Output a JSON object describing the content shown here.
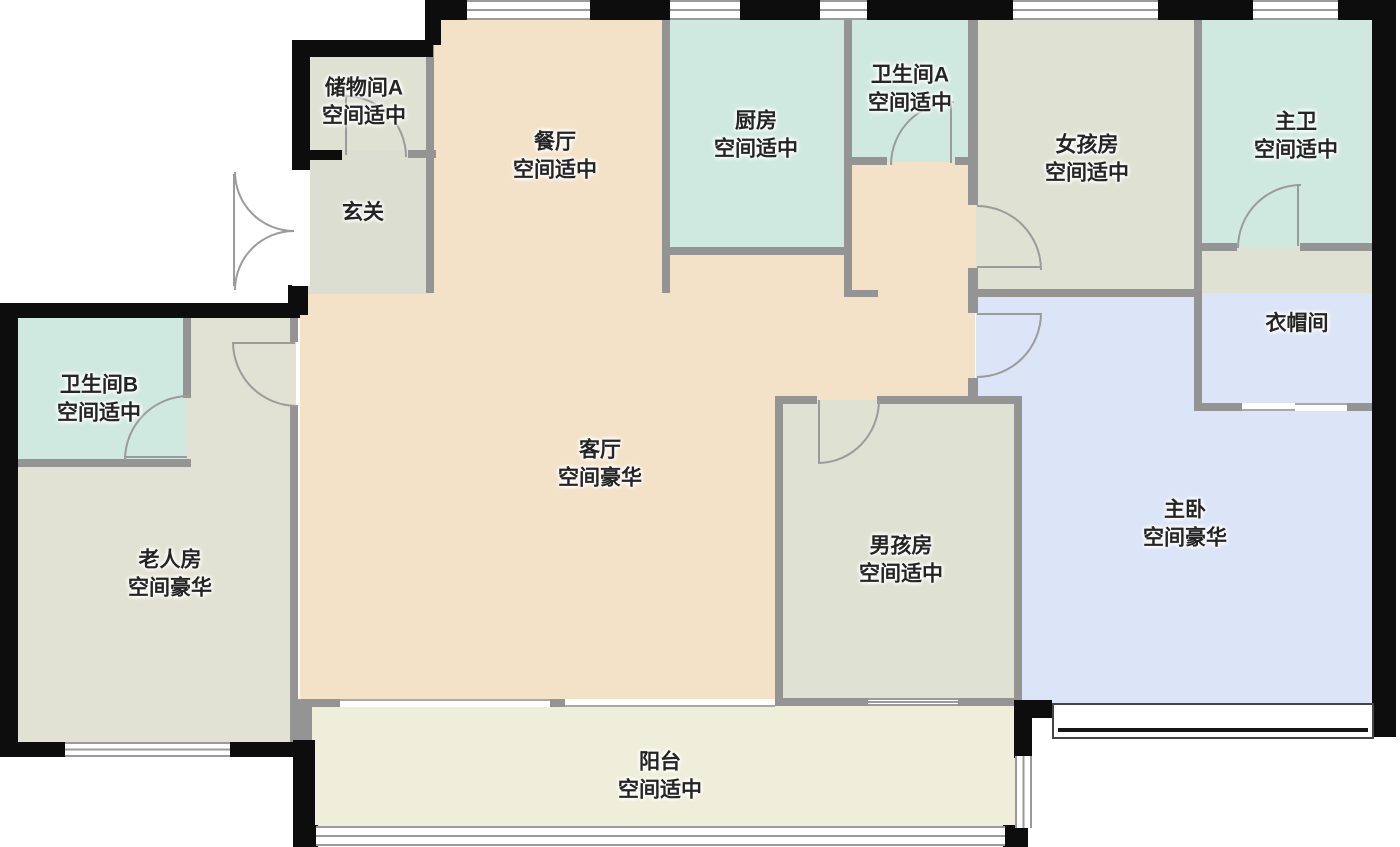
{
  "palette": {
    "wall_black": "#0d0d0d",
    "wall_gray": "#949494",
    "door_arc": "#9b9b9b",
    "dining_living": "#f3e1c8",
    "wet_room": "#cfe9e1",
    "gray_green_room": "#dfe1d3",
    "entry_green": "#dbded0",
    "elderly_room": "#e2e2d4",
    "master_blue": "#dce4f7",
    "balcony_cream": "#efeeda"
  },
  "rooms": {
    "storage_a": {
      "name": "储物间A",
      "status": "空间适中"
    },
    "entry": {
      "name": "玄关"
    },
    "dining": {
      "name": "餐厅",
      "status": "空间适中"
    },
    "kitchen": {
      "name": "厨房",
      "status": "空间适中"
    },
    "bath_a": {
      "name": "卫生间A",
      "status": "空间适中"
    },
    "girls_room": {
      "name": "女孩房",
      "status": "空间适中"
    },
    "master_bath": {
      "name": "主卫",
      "status": "空间适中"
    },
    "cloakroom": {
      "name": "衣帽间"
    },
    "bath_b": {
      "name": "卫生间B",
      "status": "空间适中"
    },
    "elderly_room": {
      "name": "老人房",
      "status": "空间豪华"
    },
    "living_room": {
      "name": "客厅",
      "status": "空间豪华"
    },
    "boys_room": {
      "name": "男孩房",
      "status": "空间适中"
    },
    "master_bedroom": {
      "name": "主卧",
      "status": "空间豪华"
    },
    "balcony": {
      "name": "阳台",
      "status": "空间适中"
    }
  }
}
